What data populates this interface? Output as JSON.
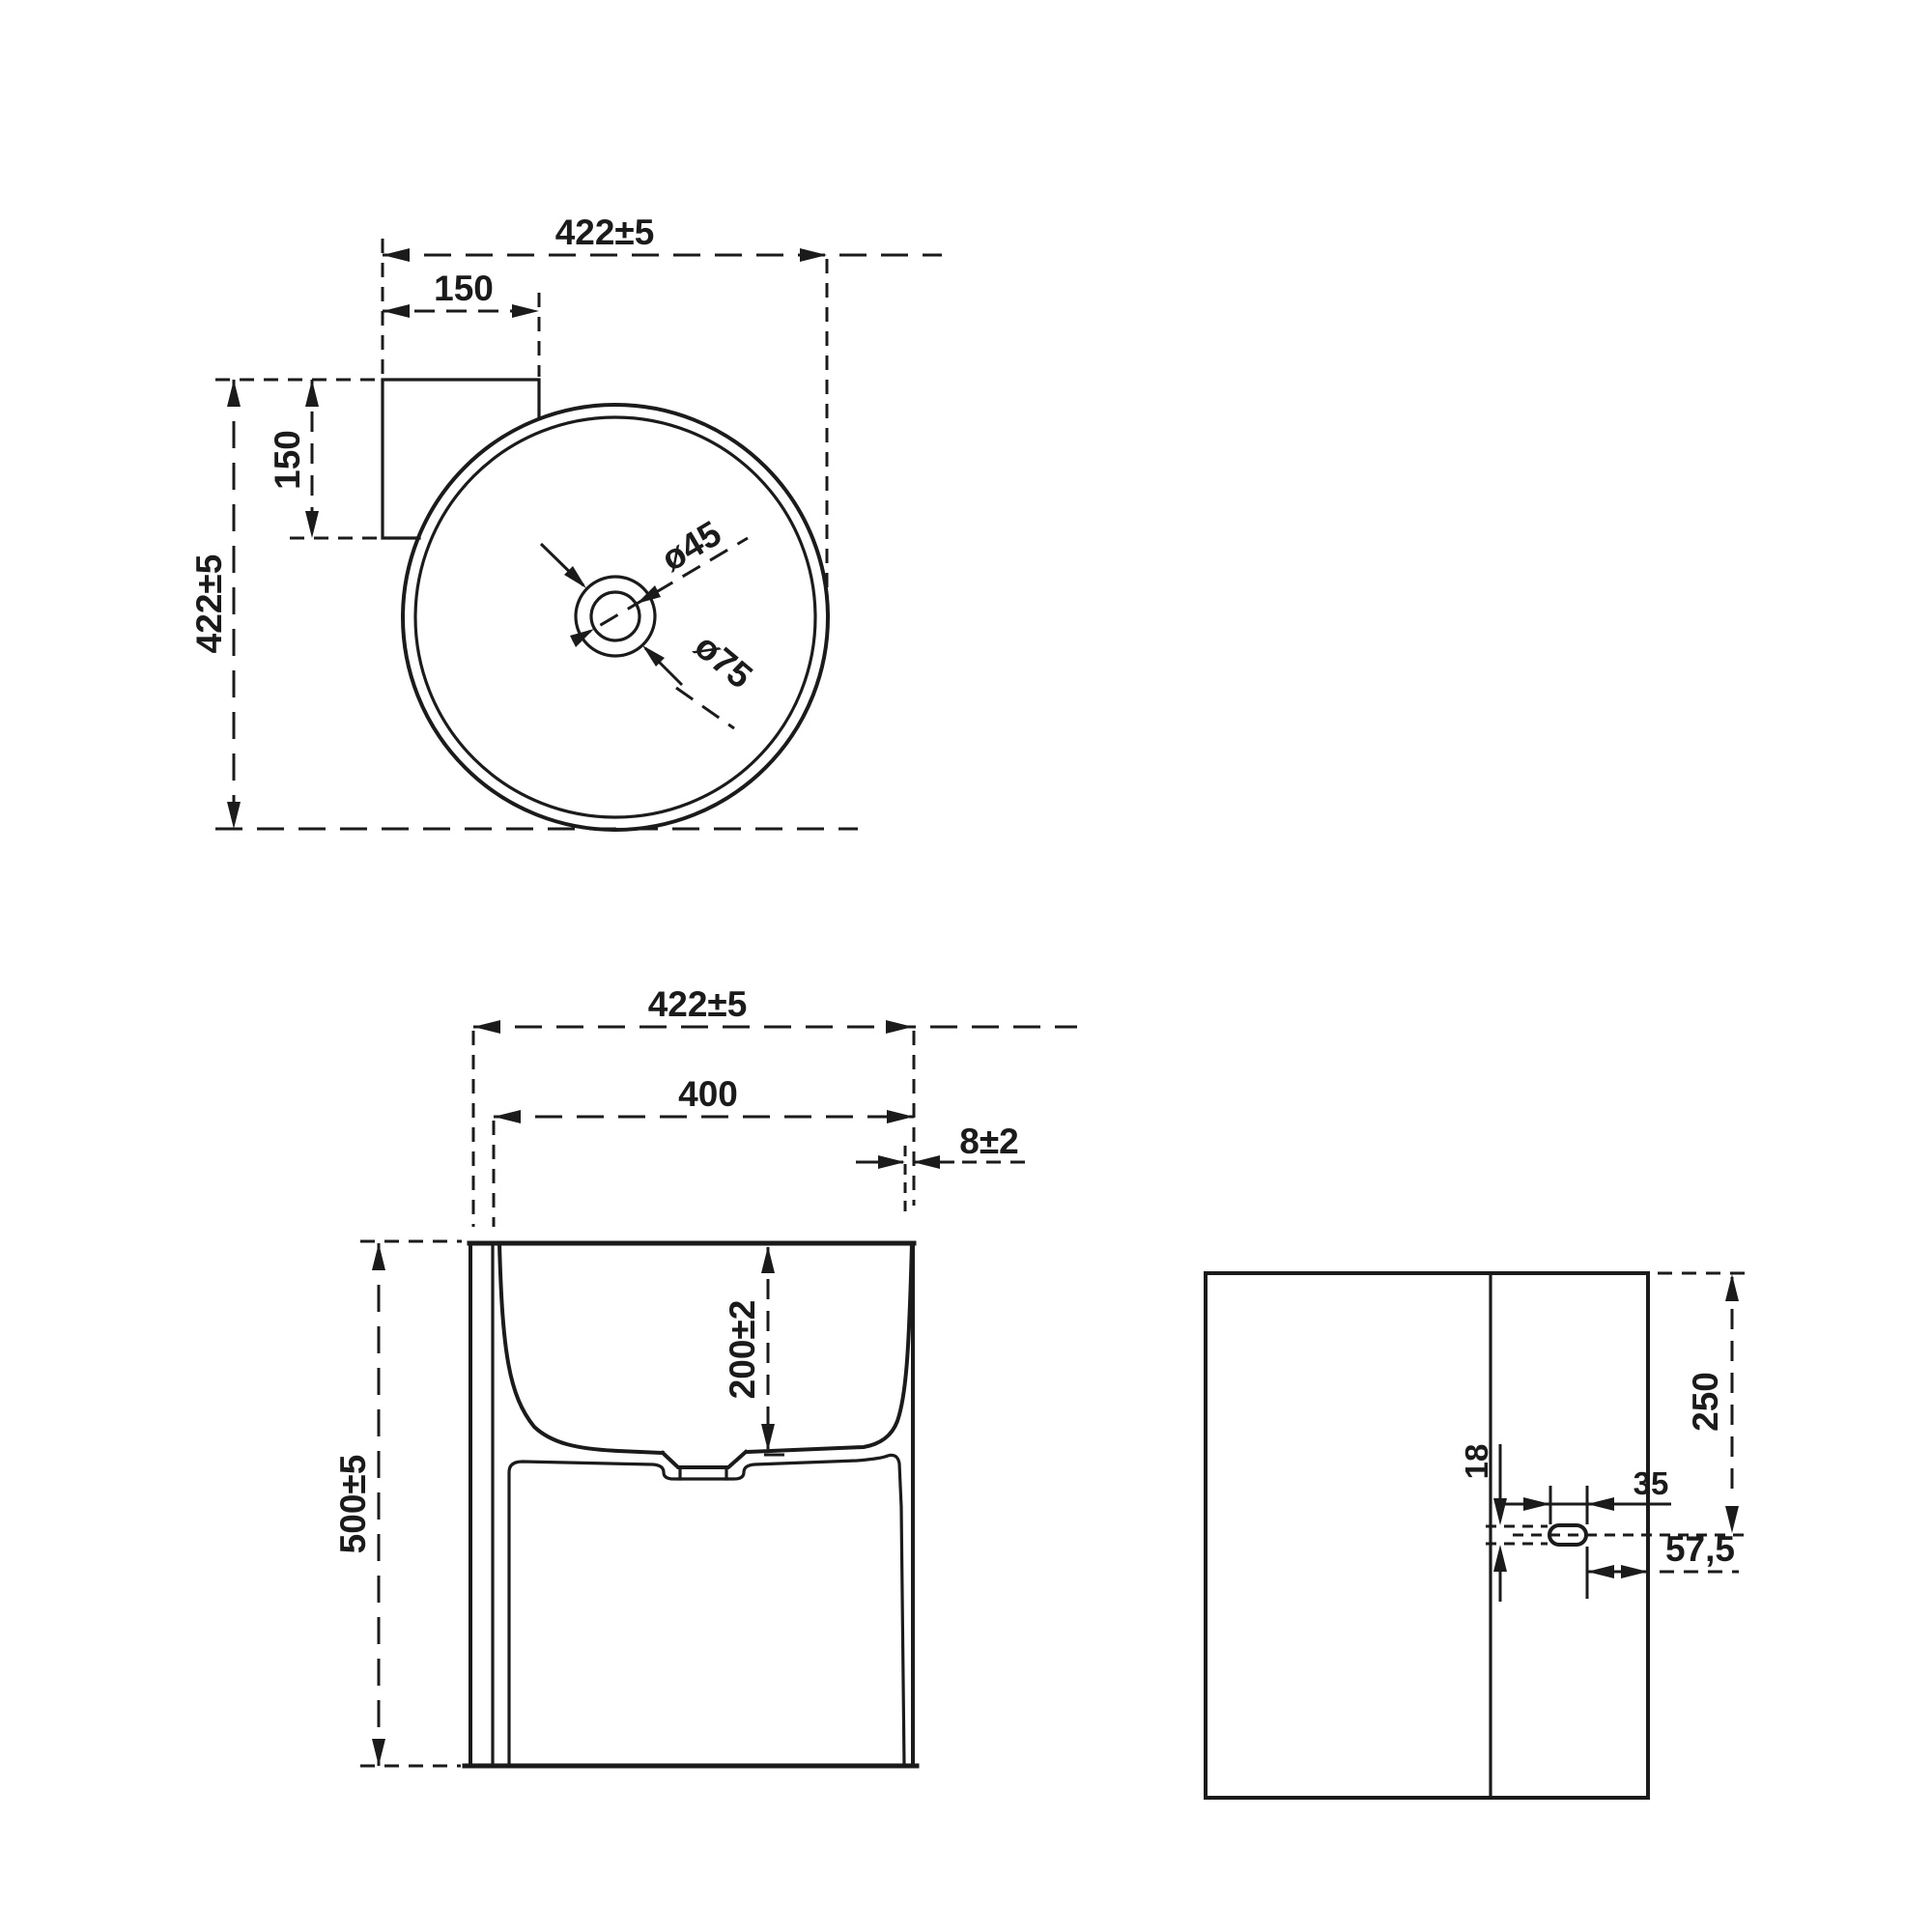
{
  "drawing": {
    "background": "#ffffff",
    "line_color": "#1b1b1b"
  },
  "views": {
    "top": {
      "name": "top-view",
      "dims": {
        "overall_width": "422±5",
        "tab_width": "150",
        "tab_depth": "150",
        "overall_depth": "422±5",
        "drain_hole_diameter": "ø45",
        "drain_recess_diameter": "ø75"
      }
    },
    "front": {
      "name": "front-view",
      "dims": {
        "overall_width": "422±5",
        "inner_width": "400",
        "rim_wall_thickness": "8±2",
        "basin_depth": "200±2",
        "overall_height": "500±5"
      }
    },
    "side": {
      "name": "side-view",
      "dims": {
        "top_to_hole_center": "250",
        "hole_height": "18",
        "hole_width": "35",
        "hole_to_front_edge": "57,5"
      }
    }
  }
}
